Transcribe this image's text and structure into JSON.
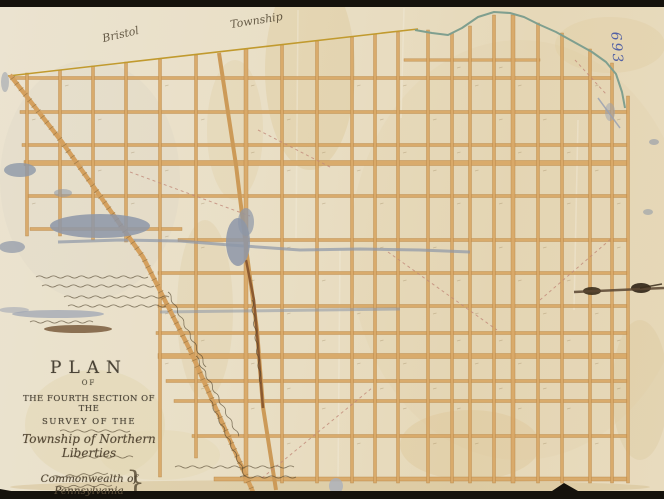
{
  "page": {
    "description": "Scanned manuscript survey plan on aged, damaged paper showing a hand-drawn orange street grid with diagonal roads and creek boundary",
    "frame_color": "#15120c",
    "paper_color": "#e9dfc6"
  },
  "labels": {
    "township_left": "Bristol",
    "township_right": "Township",
    "archive_number": "693"
  },
  "title_block": {
    "line1": "PLAN",
    "line2": "OF",
    "line3": "THE FOURTH SECTION OF THE",
    "line4": "SURVEY OF THE",
    "line5": "Township of Northern Liberties",
    "line7": "Commonwealth of Pennsylvania",
    "signature_brace": "}"
  },
  "annotations": {
    "left_margin_note": "several lines of illegible handwritten script",
    "small_title_lines": "illegible small script lines within title block",
    "signature_note": "illegible handwritten signatures joined by a brace",
    "road_label_note": "illegible script names written along diagonal roads",
    "block_numbers_note": "faint illegible lot numbers inside grid blocks"
  },
  "map": {
    "street_color": "#d9a968",
    "street_edge_color": "#b4813f",
    "boundary_color": "#c19a2e",
    "creek_color": "#7f9f8f",
    "water_damage_color": "#8d97a8",
    "ink_color": "#4a4133",
    "script_ink_color": "#53462f",
    "number_ink_color": "#4556a4",
    "grid": {
      "verticals": [
        [
          27,
          73,
          236,
          3
        ],
        [
          60,
          70,
          236,
          3
        ],
        [
          93,
          66,
          240,
          3
        ],
        [
          126,
          62,
          242,
          3
        ],
        [
          160,
          59,
          477,
          3
        ],
        [
          196,
          55,
          458,
          3
        ],
        [
          246,
          49,
          483,
          4
        ],
        [
          282,
          45,
          483,
          3
        ],
        [
          317,
          41,
          483,
          3
        ],
        [
          352,
          37,
          483,
          3
        ],
        [
          375,
          34,
          483,
          3
        ],
        [
          398,
          32,
          483,
          3
        ],
        [
          428,
          30,
          483,
          3
        ],
        [
          452,
          33,
          483,
          3
        ],
        [
          470,
          26,
          483,
          3
        ],
        [
          494,
          15,
          483,
          3
        ],
        [
          513,
          15,
          483,
          4
        ],
        [
          538,
          23,
          483,
          3
        ],
        [
          562,
          33,
          483,
          3
        ],
        [
          590,
          49,
          483,
          3
        ],
        [
          612,
          63,
          483,
          3
        ],
        [
          628,
          96,
          483,
          3
        ]
      ],
      "horizontals": [
        [
          60,
          404,
          540,
          2.5
        ],
        [
          78,
          14,
          612,
          3
        ],
        [
          112,
          20,
          628,
          3
        ],
        [
          145,
          22,
          628,
          3
        ],
        [
          163,
          24,
          628,
          5
        ],
        [
          196,
          27,
          628,
          3
        ],
        [
          229,
          30,
          182,
          3
        ],
        [
          240,
          178,
          628,
          3
        ],
        [
          273,
          158,
          628,
          3
        ],
        [
          306,
          158,
          628,
          3
        ],
        [
          333,
          156,
          628,
          3
        ],
        [
          356,
          158,
          628,
          5
        ],
        [
          381,
          166,
          628,
          3
        ],
        [
          401,
          174,
          628,
          3
        ],
        [
          436,
          192,
          628,
          3
        ],
        [
          479,
          214,
          628,
          4
        ]
      ]
    },
    "boundary_line": {
      "points": [
        [
          8,
          76
        ],
        [
          418,
          29
        ]
      ],
      "width": 1.6
    },
    "creek": {
      "points": [
        [
          415,
          30
        ],
        [
          432,
          33
        ],
        [
          448,
          35
        ],
        [
          462,
          28
        ],
        [
          478,
          17
        ],
        [
          494,
          12
        ],
        [
          510,
          13
        ],
        [
          524,
          17
        ],
        [
          538,
          24
        ],
        [
          556,
          32
        ],
        [
          574,
          42
        ],
        [
          592,
          52
        ],
        [
          606,
          62
        ],
        [
          616,
          74
        ],
        [
          622,
          92
        ],
        [
          625,
          108
        ]
      ],
      "width": 2
    },
    "roads": [
      {
        "name": "western-diagonal-road",
        "points": [
          [
            10,
            75
          ],
          [
            62,
            142
          ],
          [
            143,
            257
          ],
          [
            190,
            350
          ],
          [
            253,
            492
          ]
        ],
        "width": 4.5,
        "color": "#d4a05e",
        "hatched": true
      },
      {
        "name": "central-diagonal-road",
        "points": [
          [
            219,
            53
          ],
          [
            236,
            165
          ],
          [
            247,
            255
          ],
          [
            257,
            330
          ],
          [
            263,
            407
          ],
          [
            276,
            490
          ]
        ],
        "width": 4,
        "color": "#cc9a58",
        "hatched": false
      },
      {
        "name": "central-road-stain",
        "points": [
          [
            246,
            260
          ],
          [
            254,
            300
          ],
          [
            258,
            345
          ],
          [
            261,
            385
          ],
          [
            263,
            408
          ]
        ],
        "width": 2.5,
        "color": "#7a4a28",
        "opacity": 0.8,
        "hatched": false
      }
    ],
    "gray_streaks": [
      {
        "points": [
          [
            58,
            242
          ],
          [
            120,
            240
          ],
          [
            180,
            241
          ],
          [
            230,
            245
          ],
          [
            300,
            250
          ],
          [
            360,
            249
          ],
          [
            420,
            250
          ],
          [
            470,
            252
          ]
        ],
        "width": 3,
        "opacity": 0.7
      },
      {
        "points": [
          [
            160,
            312
          ],
          [
            240,
            311
          ],
          [
            320,
            310
          ],
          [
            400,
            309
          ]
        ],
        "width": 3,
        "opacity": 0.55
      }
    ],
    "dashed_lines": [
      [
        130,
        172,
        250,
        216
      ],
      [
        258,
        130,
        332,
        168
      ],
      [
        388,
        252,
        497,
        330
      ],
      [
        262,
        478,
        372,
        388
      ],
      [
        540,
        300,
        612,
        238
      ],
      [
        575,
        60,
        606,
        94
      ]
    ],
    "creases": [
      [
        298,
        10,
        296,
        240
      ],
      [
        404,
        8,
        401,
        118
      ],
      [
        578,
        120,
        574,
        310
      ],
      [
        340,
        250,
        338,
        480
      ]
    ],
    "damage_blobs": [
      [
        20,
        170,
        16,
        7,
        "#8d97a8",
        0.8
      ],
      [
        100,
        226,
        50,
        12,
        "#8d97a8",
        0.85
      ],
      [
        12,
        247,
        13,
        6,
        "#8d97a8",
        0.7
      ],
      [
        63,
        193,
        9,
        4,
        "#8d97a8",
        0.55
      ],
      [
        58,
        314,
        46,
        4,
        "#9aa2b2",
        0.7
      ],
      [
        14,
        310,
        15,
        3,
        "#9aa2b2",
        0.55
      ],
      [
        238,
        242,
        12,
        24,
        "#8d97a8",
        0.85
      ],
      [
        246,
        222,
        8,
        14,
        "#8d97a8",
        0.7
      ],
      [
        336,
        486,
        7,
        8,
        "#aab0bc",
        0.8
      ],
      [
        654,
        142,
        5,
        3,
        "#8d97a8",
        0.6
      ],
      [
        648,
        212,
        5,
        3,
        "#8d97a8",
        0.55
      ],
      [
        592,
        291,
        9,
        4,
        "#3a2d1c",
        0.9
      ],
      [
        641,
        288,
        10,
        5,
        "#2f2416",
        0.9
      ],
      [
        78,
        329,
        34,
        4,
        "#6b4a2a",
        0.75
      ],
      [
        610,
        112,
        5,
        9,
        "#9aa2b2",
        0.5
      ],
      [
        5,
        82,
        4,
        10,
        "#8d97a8",
        0.5
      ]
    ],
    "tear_lines": [
      [
        574,
        292,
        664,
        288,
        "#5a4632",
        2.5
      ],
      [
        598,
        98,
        620,
        128,
        "#9aa2b2",
        1.5
      ],
      [
        640,
        288,
        662,
        284,
        "#3a2d1c",
        1.5
      ]
    ],
    "stains": [
      [
        310,
        70,
        45,
        100,
        "#d9bf85",
        0.28
      ],
      [
        235,
        130,
        28,
        70,
        "#dfc897",
        0.25
      ],
      [
        470,
        445,
        70,
        35,
        "#d9bf8a",
        0.3
      ],
      [
        610,
        45,
        55,
        28,
        "#dfca9c",
        0.3
      ],
      [
        95,
        425,
        70,
        55,
        "#e0d0a6",
        0.35
      ],
      [
        205,
        310,
        28,
        90,
        "#d6bd8c",
        0.22
      ],
      [
        640,
        390,
        28,
        70,
        "#d9c294",
        0.28
      ],
      [
        520,
        250,
        170,
        210,
        "#decb9d",
        0.15
      ],
      [
        90,
        180,
        90,
        120,
        "#d3cdc0",
        0.18
      ],
      [
        330,
        487,
        320,
        7,
        "#d2bd8c",
        0.45
      ],
      [
        160,
        455,
        60,
        25,
        "#e4d6b2",
        0.4
      ]
    ],
    "squiggles": [
      [
        36,
        277,
        112,
        0
      ],
      [
        42,
        286,
        108,
        0
      ],
      [
        64,
        297,
        100,
        0
      ],
      [
        68,
        306,
        96,
        0
      ],
      [
        30,
        322,
        58,
        0
      ],
      [
        60,
        431,
        66,
        0
      ],
      [
        70,
        457,
        58,
        0
      ],
      [
        175,
        467,
        118,
        0
      ],
      [
        240,
        477,
        52,
        0
      ],
      [
        52,
        477,
        56,
        -4
      ],
      [
        56,
        487,
        52,
        -2
      ],
      [
        168,
        292,
        80,
        63
      ],
      [
        196,
        356,
        86,
        62
      ],
      [
        210,
        400,
        80,
        65
      ],
      [
        252,
        300,
        80,
        84
      ]
    ],
    "frame": {
      "top_height": 7,
      "bottom_y": 491,
      "notch": [
        [
          552,
          491
        ],
        [
          564,
          483
        ],
        [
          578,
          491
        ]
      ],
      "corner_wedge": [
        [
          0,
          489
        ],
        [
          28,
          494
        ],
        [
          0,
          499
        ]
      ]
    }
  }
}
